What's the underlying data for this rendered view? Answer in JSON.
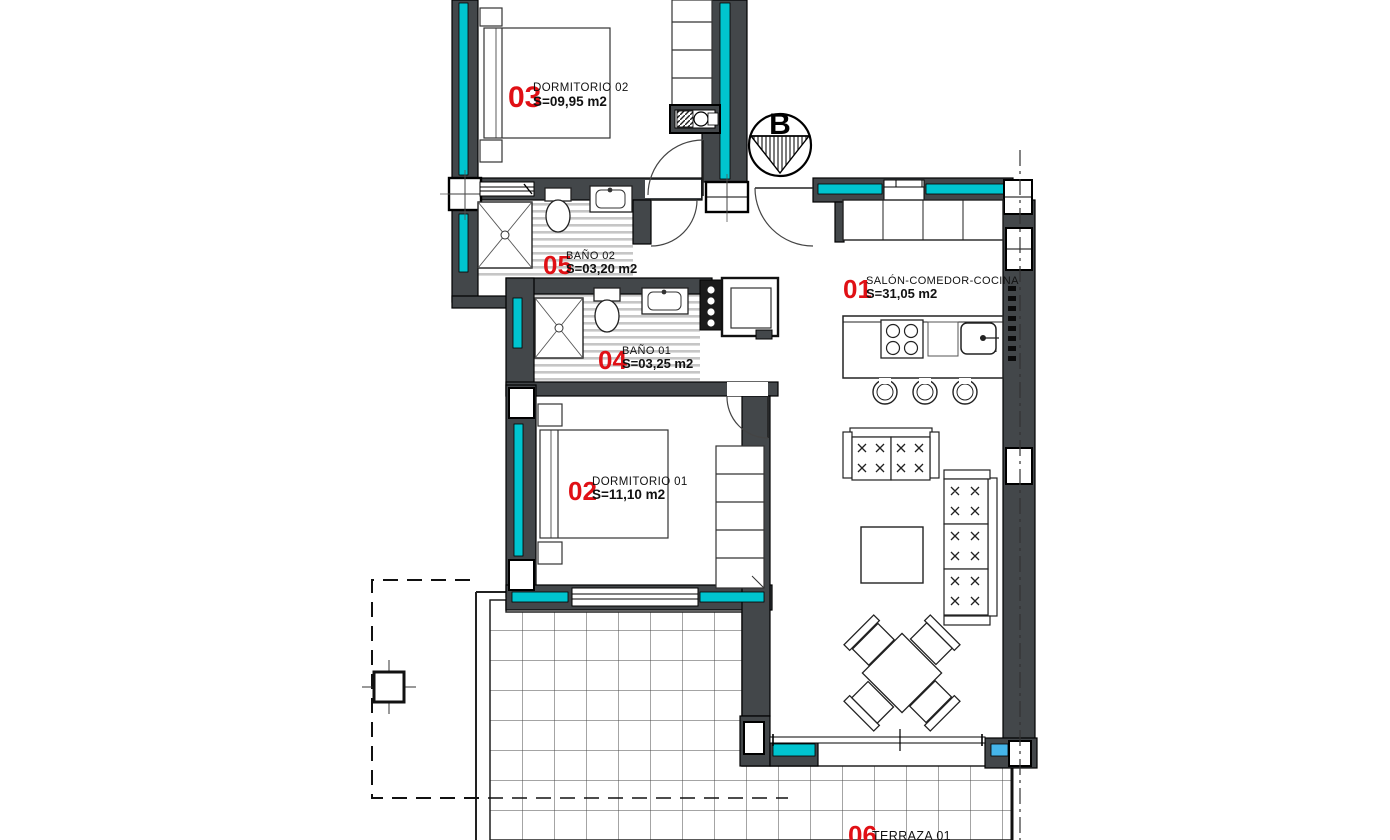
{
  "plan": {
    "compass": {
      "label": "B"
    },
    "rooms": [
      {
        "id": "01",
        "name": "SALÓN-COMEDOR-COCINA",
        "area": "S=31,05 m2"
      },
      {
        "id": "02",
        "name": "DORMITORIO 01",
        "area": "S=11,10 m2"
      },
      {
        "id": "03",
        "name": "DORMITORIO 02",
        "area": "S=09,95 m2"
      },
      {
        "id": "04",
        "name": "BAÑO 01",
        "area": "S=03,25 m2"
      },
      {
        "id": "05",
        "name": "BAÑO 02",
        "area": "S=03,20 m2"
      },
      {
        "id": "06",
        "name": "TERRAZA 01",
        "area": ""
      }
    ],
    "colors": {
      "wall": "#43474a",
      "insulation": "#00c4cf",
      "room_number": "#e01015",
      "window_insulation": "#45b5ea"
    }
  }
}
